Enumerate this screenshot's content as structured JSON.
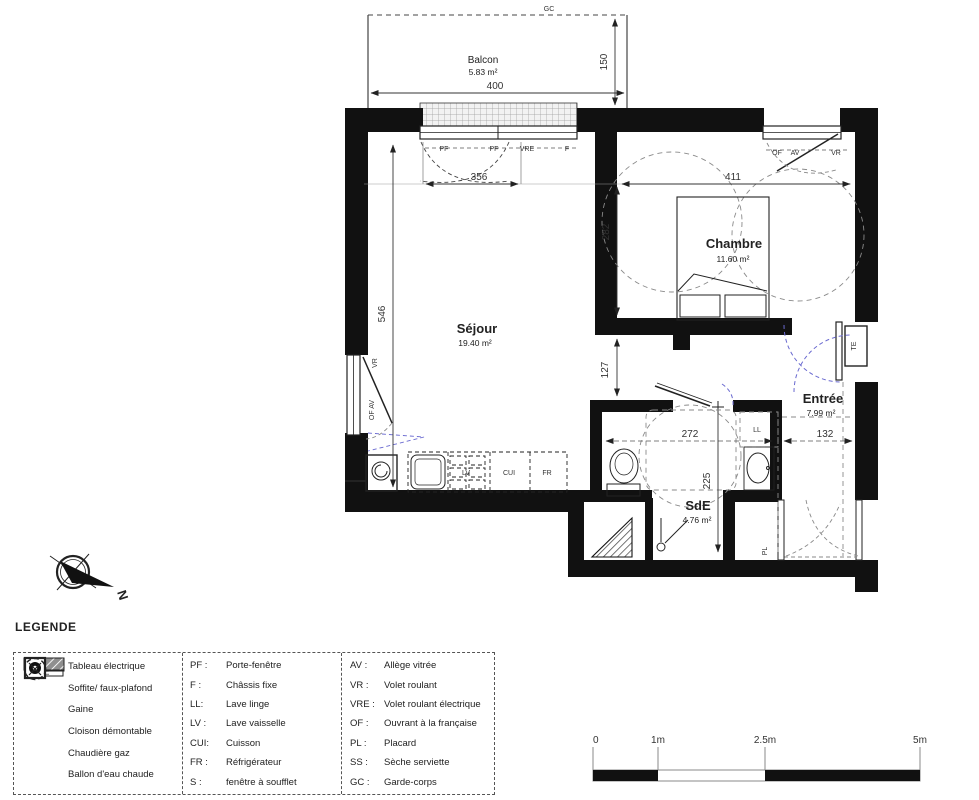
{
  "plan": {
    "rooms": {
      "balcon": {
        "name": "Balcon",
        "area": "5.83 m²"
      },
      "sejour": {
        "name": "Séjour",
        "area": "19.40 m²"
      },
      "chambre": {
        "name": "Chambre",
        "area": "11.60 m²"
      },
      "entree": {
        "name": "Entrée",
        "area": "7.99 m²"
      },
      "sde": {
        "name": "SdE",
        "area": "4.76 m²"
      }
    },
    "dims": {
      "d400": "400",
      "d150": "150",
      "d356": "356",
      "d411": "411",
      "d282": "282",
      "d546": "546",
      "d127": "127",
      "d272": "272",
      "d132": "132",
      "d225": "225"
    },
    "labels": {
      "gc": "GC",
      "pf": "PF",
      "vre": "VRE",
      "f": "F",
      "of": "OF",
      "av": "AV",
      "vr": "VR",
      "of_av": "OF  AV",
      "te": "TE",
      "ll": "LL",
      "pl": "PL",
      "lv": "LV",
      "cui": "CUI",
      "fr": "FR"
    },
    "compass_north": "N"
  },
  "legend": {
    "title": "LEGENDE",
    "symbols": [
      {
        "icon": "tableau-electrique-symbol",
        "symbol_text": "TE",
        "label": "Tableau électrique"
      },
      {
        "icon": "soffite-symbol",
        "label": "Soffite/ faux-plafond"
      },
      {
        "icon": "gaine-symbol",
        "label": "Gaine"
      },
      {
        "icon": "cloison-demontable-symbol",
        "label": "Cloison démontable"
      },
      {
        "icon": "chaudiere-gaz-symbol",
        "label": "Chaudière gaz"
      },
      {
        "icon": "ballon-eau-chaude-symbol",
        "label": "Ballon d'eau chaude"
      }
    ],
    "col2": [
      {
        "abbr": "PF :",
        "label": "Porte-fenêtre"
      },
      {
        "abbr": "F :",
        "label": "Châssis fixe"
      },
      {
        "abbr": "LL:",
        "label": "Lave linge"
      },
      {
        "abbr": "LV :",
        "label": "Lave vaisselle"
      },
      {
        "abbr": "CUI:",
        "label": "Cuisson"
      },
      {
        "abbr": "FR :",
        "label": "Réfrigérateur"
      },
      {
        "abbr": "S :",
        "label": "fenêtre à soufflet"
      }
    ],
    "col3": [
      {
        "abbr": "AV :",
        "label": "Allège vitrée"
      },
      {
        "abbr": "VR :",
        "label": "Volet roulant"
      },
      {
        "abbr": "VRE :",
        "label": "Volet roulant électrique"
      },
      {
        "abbr": "OF :",
        "label": "Ouvrant à la française"
      },
      {
        "abbr": "PL :",
        "label": "Placard"
      },
      {
        "abbr": "SS :",
        "label": "Sèche serviette"
      },
      {
        "abbr": "GC :",
        "label": "Garde-corps"
      }
    ]
  },
  "scale_bar": {
    "labels": [
      "0",
      "1m",
      "2.5m",
      "5m"
    ]
  },
  "colors": {
    "wall": "#111111",
    "door_arc": "#6a6ad0",
    "line": "#333333",
    "circulation": "#8a8a8a"
  }
}
